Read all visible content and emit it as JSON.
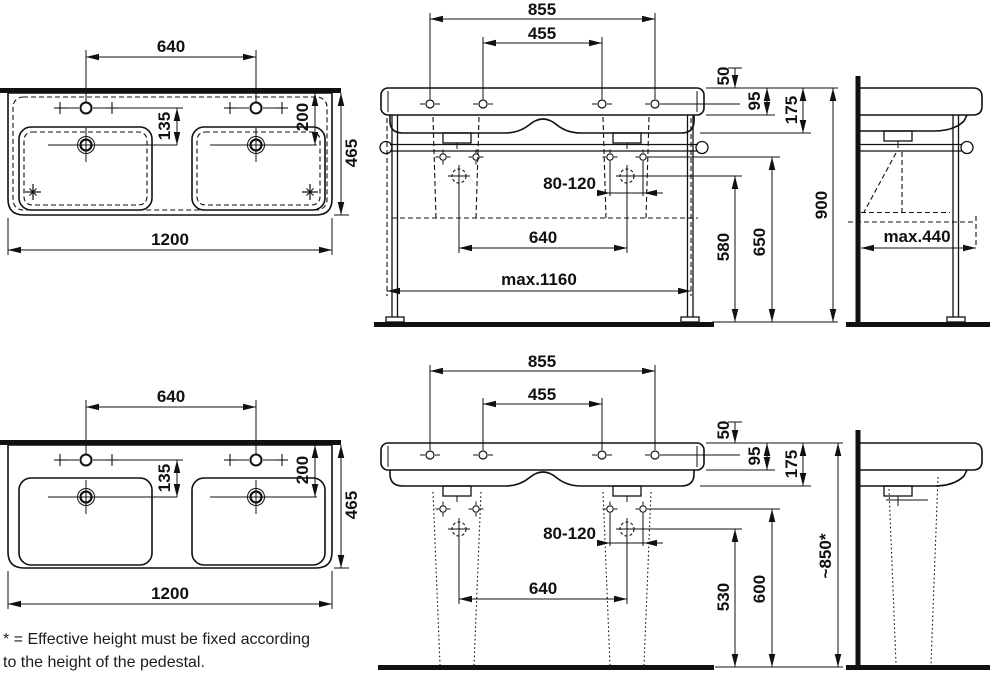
{
  "footnote": {
    "line1": "* = Effective height must be fixed according",
    "line2": "to the height of the pedestal."
  },
  "plan_frame": {
    "tap_spacing": "640",
    "tap_to_drain": "135",
    "rim_to_drain": "200",
    "depth": "465",
    "width": "1200"
  },
  "front_frame": {
    "outer_holes": "855",
    "inner_holes": "455",
    "rim_drop": "50",
    "rim_height": "95",
    "body_height": "175",
    "supply_range": "80-120",
    "bowl_spacing": "640",
    "supply_height": "580",
    "fixing_height": "650",
    "total_height": "900",
    "frame_width": "max.1160"
  },
  "side_frame": {
    "depth": "max.440"
  },
  "plan_pedestal": {
    "tap_spacing": "640",
    "tap_to_drain": "135",
    "rim_to_drain": "200",
    "depth": "465",
    "width": "1200"
  },
  "front_pedestal": {
    "outer_holes": "855",
    "inner_holes": "455",
    "rim_drop": "50",
    "rim_height": "95",
    "body_height": "175",
    "supply_range": "80-120",
    "bowl_spacing": "640",
    "supply_height": "530",
    "fixing_height": "600",
    "effective_height": "~850*"
  }
}
